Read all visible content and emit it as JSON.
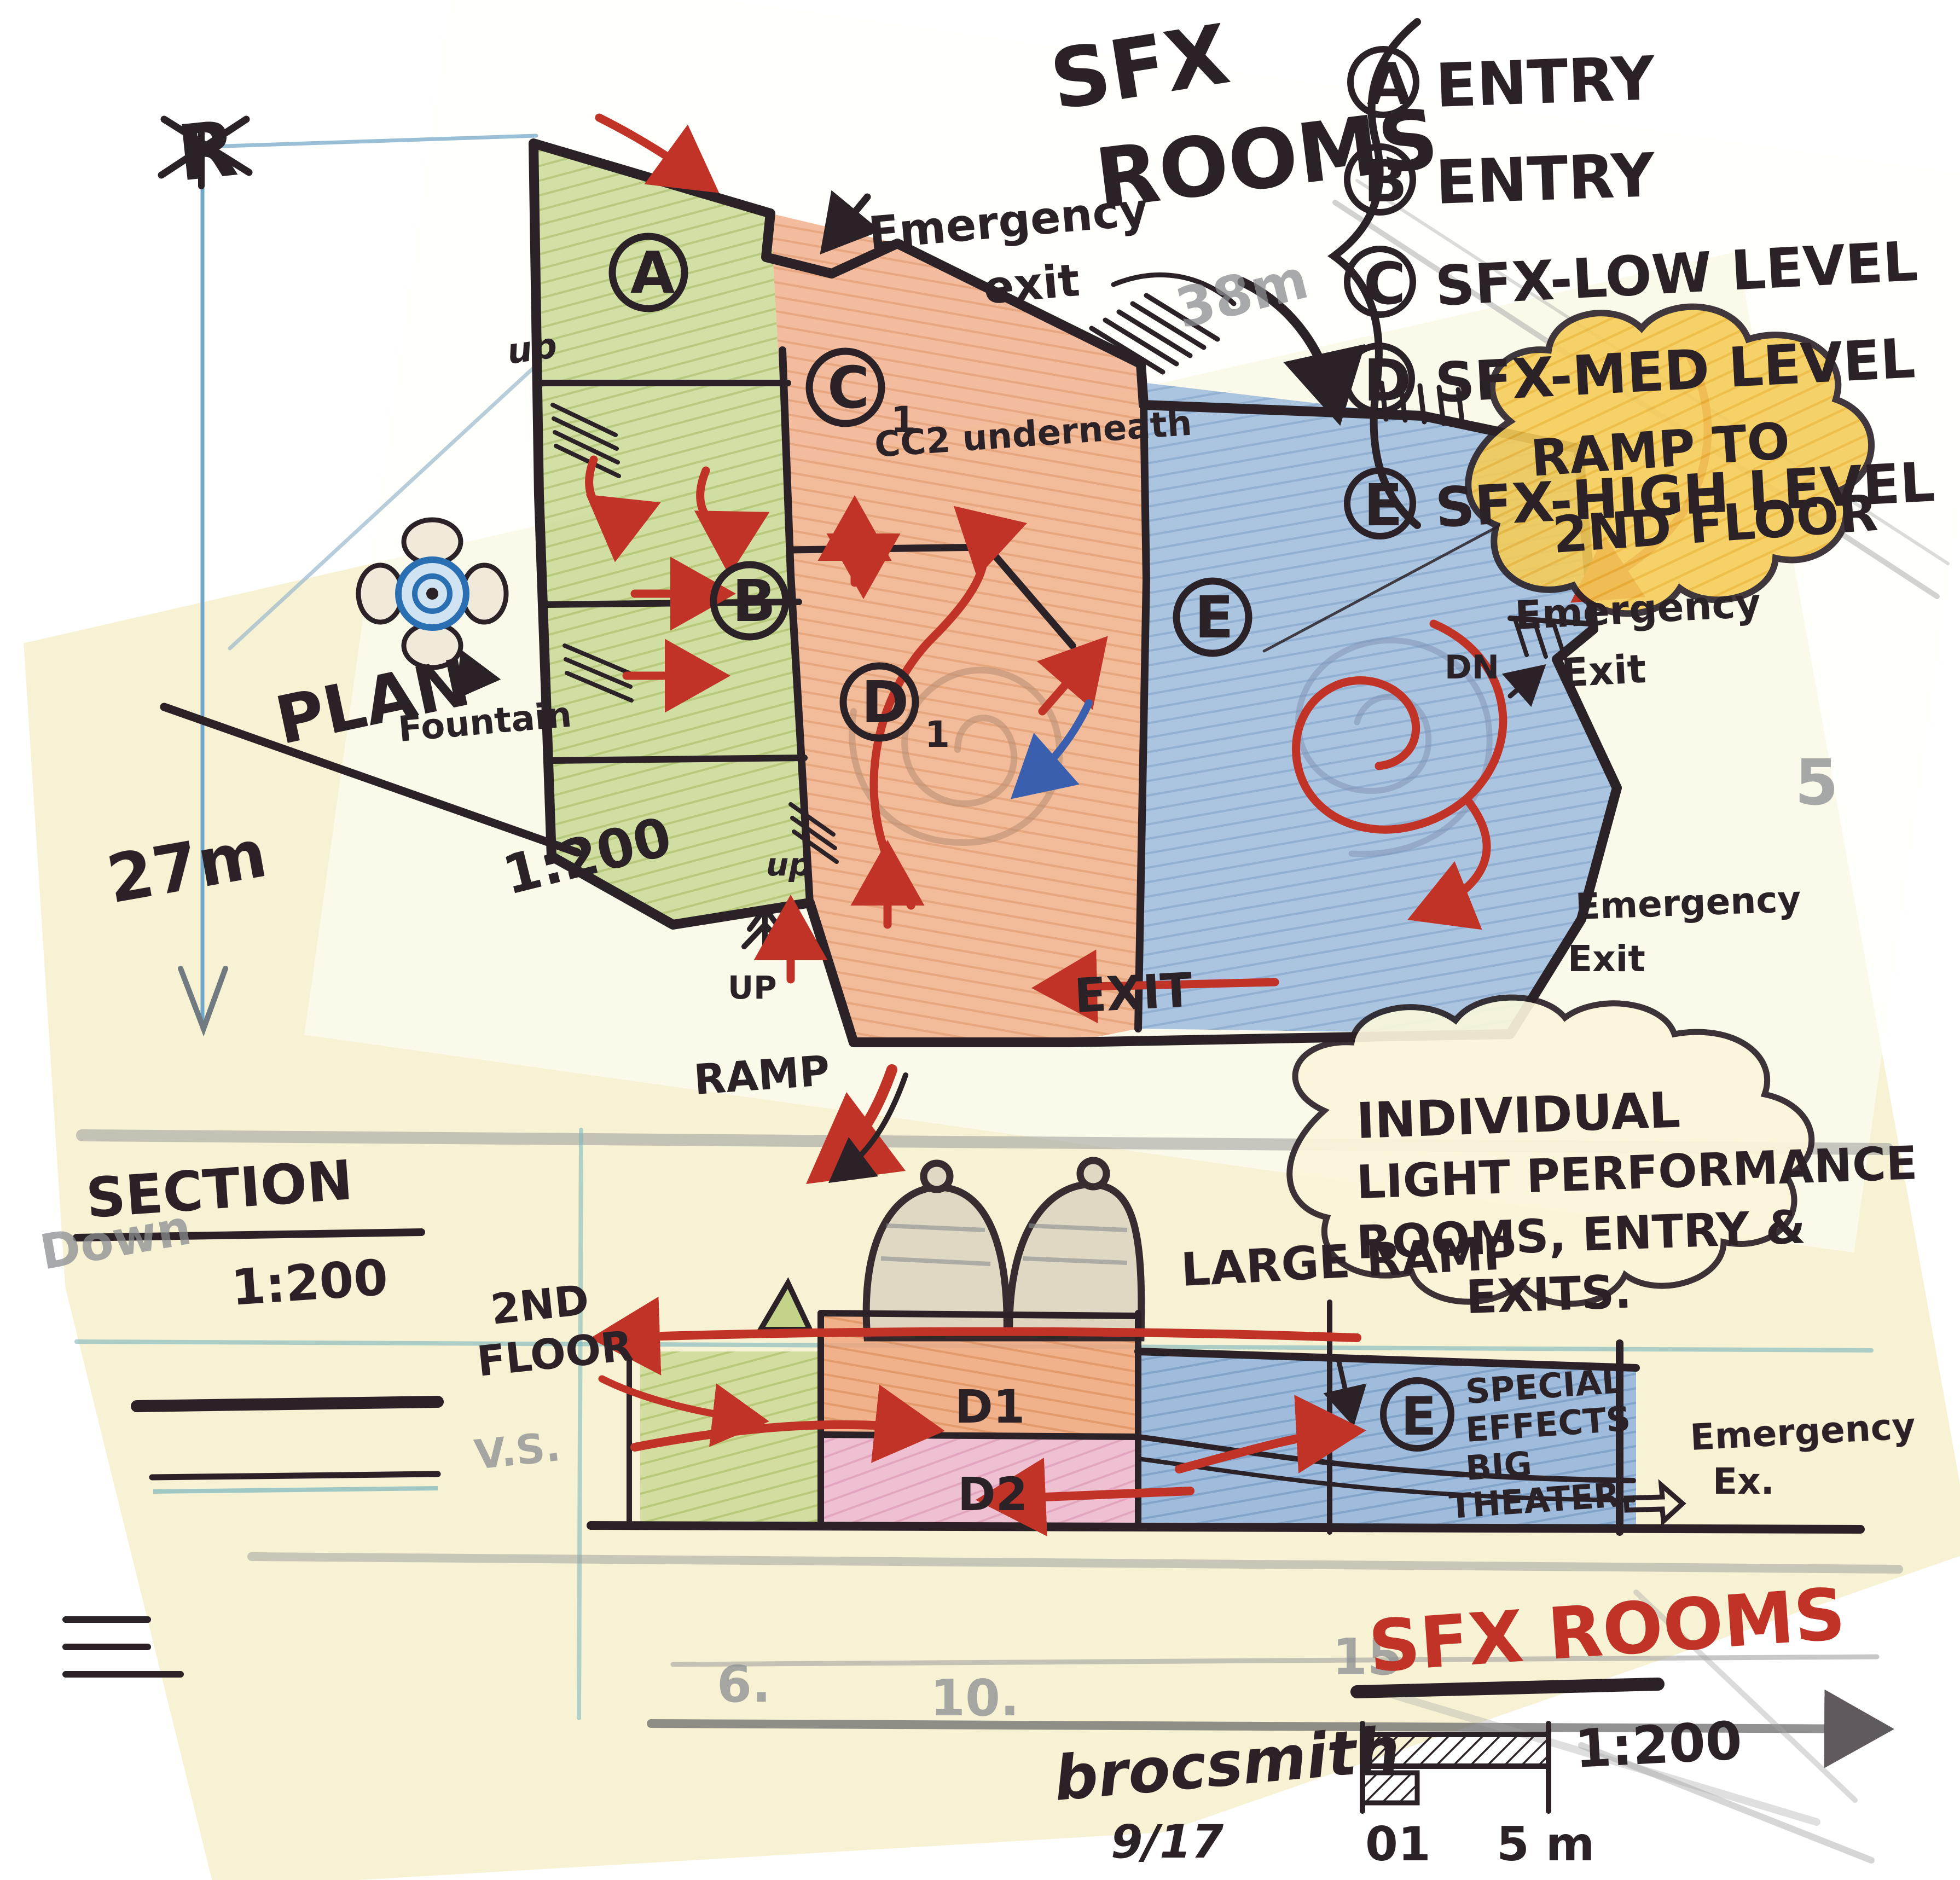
{
  "title": {
    "line1": "SFX",
    "line2": "ROOMS"
  },
  "legend": [
    {
      "key": "A",
      "text": "ENTRY"
    },
    {
      "key": "B",
      "text": "ENTRY"
    },
    {
      "key": "C",
      "text": "SFX-LOW LEVEL"
    },
    {
      "key": "D",
      "text": "SFX-MED LEVEL"
    },
    {
      "key": "E",
      "text": "SFX-HIGH LEVEL"
    }
  ],
  "plan": {
    "label": "PLAN",
    "scale": "1:200",
    "dimension_height": "27m",
    "north_mark": "R",
    "pencil_width": "38m",
    "pencil_five": "5",
    "rooms": {
      "a": "A",
      "b": "B",
      "c": "C",
      "c_sub": "1",
      "cc2_note": "CC2 underneath",
      "d": "D",
      "d_sub": "1",
      "e": "E"
    },
    "annotations": {
      "emergency_top_1": "Emergency",
      "emergency_top_2": "exit",
      "ramp_cloud_1": "RAMP TO",
      "ramp_cloud_2": "2ND FLOOR",
      "dn": "DN",
      "emergency_right_1": "Emergency",
      "emergency_right_2": "Exit",
      "emergency_lower_1": "Emergency",
      "emergency_lower_2": "Exit",
      "exit": "EXIT",
      "up_a": "up",
      "up_b": "up",
      "up_c": "UP",
      "ramp": "RAMP",
      "fountain": "Fountain"
    }
  },
  "notes_cloud": {
    "line1": "INDIVIDUAL",
    "line2": "LIGHT PERFORMANCE",
    "line3": "ROOMS, ENTRY &",
    "line4": "EXITS."
  },
  "section": {
    "label": "SECTION",
    "scale": "1:200",
    "pencil_down": "Down",
    "pencil_vs": "V.S.",
    "annotations": {
      "second_floor_1": "2ND",
      "second_floor_2": "FLOOR",
      "large_ramp": "LARGE RAMP",
      "d1": "D1",
      "d2": "D2",
      "e": "E",
      "special_1": "SPECIAL",
      "special_2": "EFFECTS",
      "special_3": "BIG",
      "special_4": "THEATER",
      "emergency_1": "Emergency",
      "emergency_2": "Ex."
    },
    "pencil_ticks": {
      "t1": "6.",
      "t2": "10.",
      "t3": "15"
    }
  },
  "titleblock": {
    "title": "SFX ROOMS",
    "scale": "1:200",
    "zero_one": "01",
    "five_m": "5 m",
    "signature": "brocsmith",
    "date": "9/17"
  },
  "colors": {
    "red_ink": "#c13326",
    "dark_ink": "#2b2228",
    "green_room": "#c3d489",
    "orange_room": "#efa67e",
    "blue_room": "#8fb3dd",
    "pink_room": "#eeb7d2",
    "yellow_cloud": "#f4cd59",
    "paper": "#f6f0cd"
  }
}
